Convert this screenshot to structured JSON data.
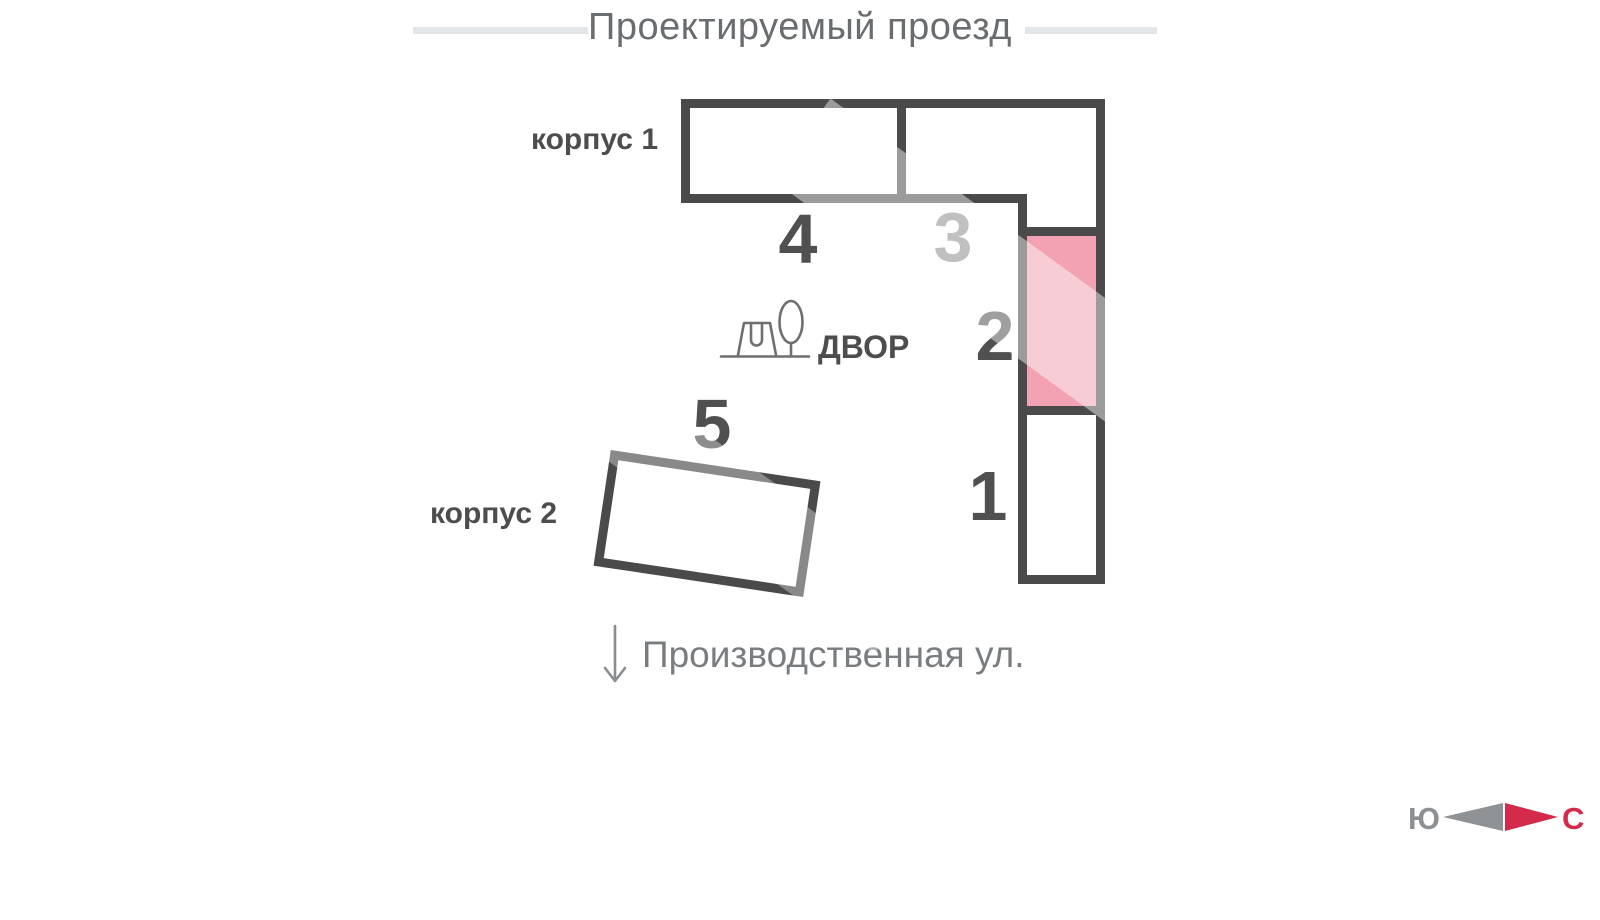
{
  "streets": {
    "top": {
      "label": "Проектируемый проезд"
    },
    "bottom": {
      "label": "Производственная ул."
    }
  },
  "buildings": {
    "korpus1": {
      "label": "корпус 1",
      "sections_shown": [
        "4",
        "3",
        "2",
        "1"
      ]
    },
    "korpus2": {
      "label": "корпус 2",
      "sections_shown": [
        "5"
      ]
    }
  },
  "sections": {
    "s1": {
      "number": "1",
      "highlighted": false
    },
    "s2": {
      "number": "2",
      "highlighted": true
    },
    "s3": {
      "number": "3",
      "highlighted": false
    },
    "s4": {
      "number": "4",
      "highlighted": false
    },
    "s5": {
      "number": "5",
      "highlighted": false
    }
  },
  "courtyard": {
    "label": "ДВОР",
    "icons": [
      "playground-icon",
      "tree-icon"
    ]
  },
  "compass": {
    "south_label": "Ю",
    "north_label": "С"
  },
  "colors": {
    "outline": "#4a4a4a",
    "highlight_fill": "#f2a2b2",
    "highlight_stripe": "#f8cad3",
    "street_line": "#e3e6e8",
    "compass_gray": "#8f9294",
    "compass_red": "#d32b49"
  }
}
